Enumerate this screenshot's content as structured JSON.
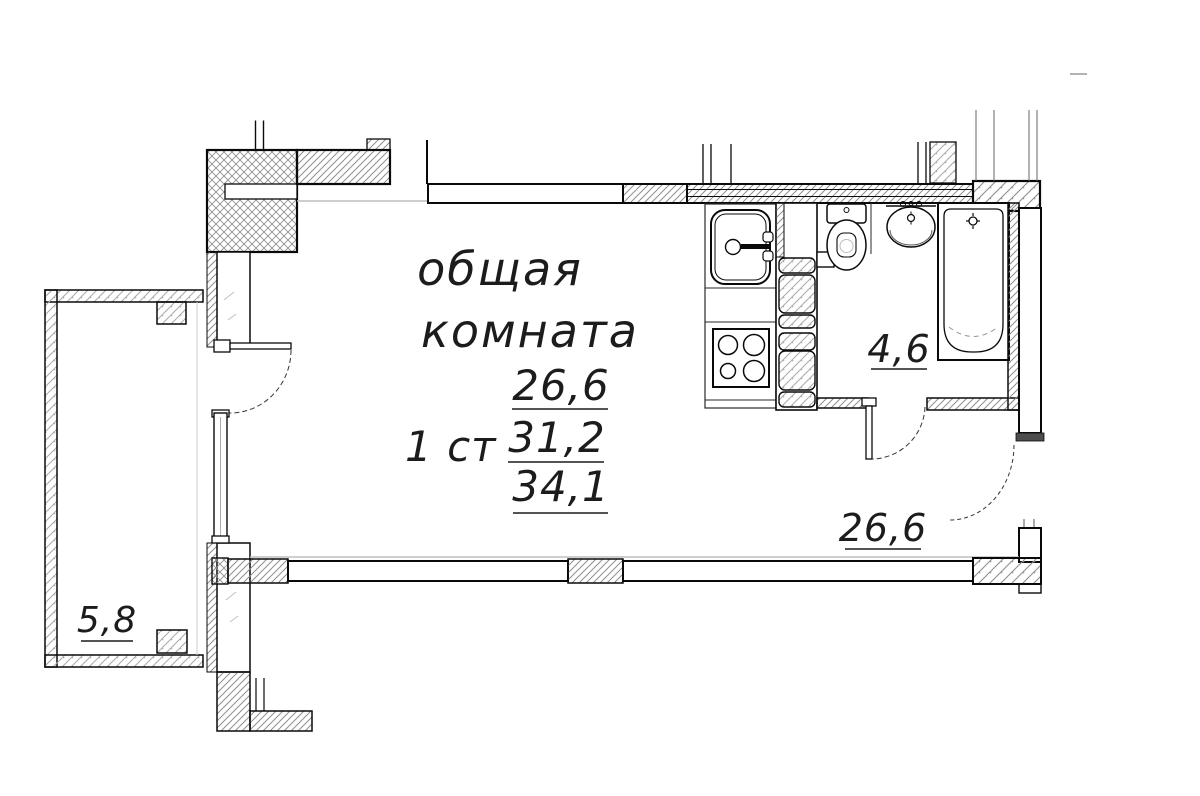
{
  "plan": {
    "room": {
      "name_line1": "общая",
      "name_line2": "комната"
    },
    "unit_type_label": "1 ст",
    "area_values": {
      "living": "26,6",
      "middle": "31,2",
      "total": "34,1"
    },
    "bathroom_area": "4,6",
    "hall_area": "26,6",
    "balcony_area": "5,8"
  },
  "colors": {
    "wall_line": "#0a0a0a",
    "hatch": "#8f8f8f",
    "hatch_light": "#a9a9a9",
    "door_leaf_fill": "#4d4d4d",
    "sill_gray": "#bdbdbd"
  }
}
